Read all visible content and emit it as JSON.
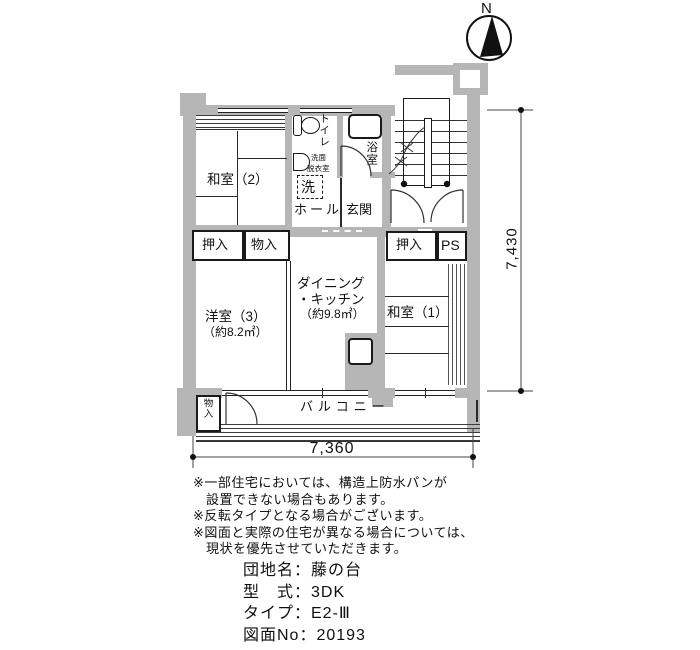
{
  "compass": {
    "label": "N"
  },
  "plan": {
    "rooms": {
      "washitsu2": "和室（2）",
      "oshiire_left": "押入",
      "monoire_left": "物入",
      "yoshitsu3_name": "洋室（3）",
      "yoshitsu3_area": "（約8.2㎡）",
      "dk_line1": "ダイニング",
      "dk_line2": "・キッチン",
      "dk_area": "（約9.8㎡）",
      "washitsu1": "和室（1）",
      "oshiire_right": "押入",
      "ps": "PS",
      "toilet": "トイレ",
      "senmen_line1": "洗面",
      "senmen_line2": "脱衣室",
      "laundry": "洗",
      "hall": "ホール",
      "genkan": "玄関",
      "bath": "浴室",
      "balcony": "バルコニー",
      "monoire_balcony": "物入"
    },
    "dimensions": {
      "vertical": "7,430",
      "horizontal": "7,360"
    }
  },
  "notes": [
    {
      "text": "※一部住宅においては、構造上防水パンが",
      "indent": false
    },
    {
      "text": "設置できない場合もあります。",
      "indent": true
    },
    {
      "text": "※反転タイプとなる場合がございます。",
      "indent": false
    },
    {
      "text": "※図面と実際の住宅が異なる場合については、",
      "indent": false
    },
    {
      "text": "現状を優先させていただきます。",
      "indent": true
    }
  ],
  "info": {
    "lines": [
      "団地名：藤の台",
      "型　式：3DK",
      "タイプ：E2-Ⅲ",
      "図面No：20193"
    ]
  },
  "colors": {
    "wall": "#b6b6b6",
    "line": "#1a1a1a",
    "background": "#ffffff"
  }
}
